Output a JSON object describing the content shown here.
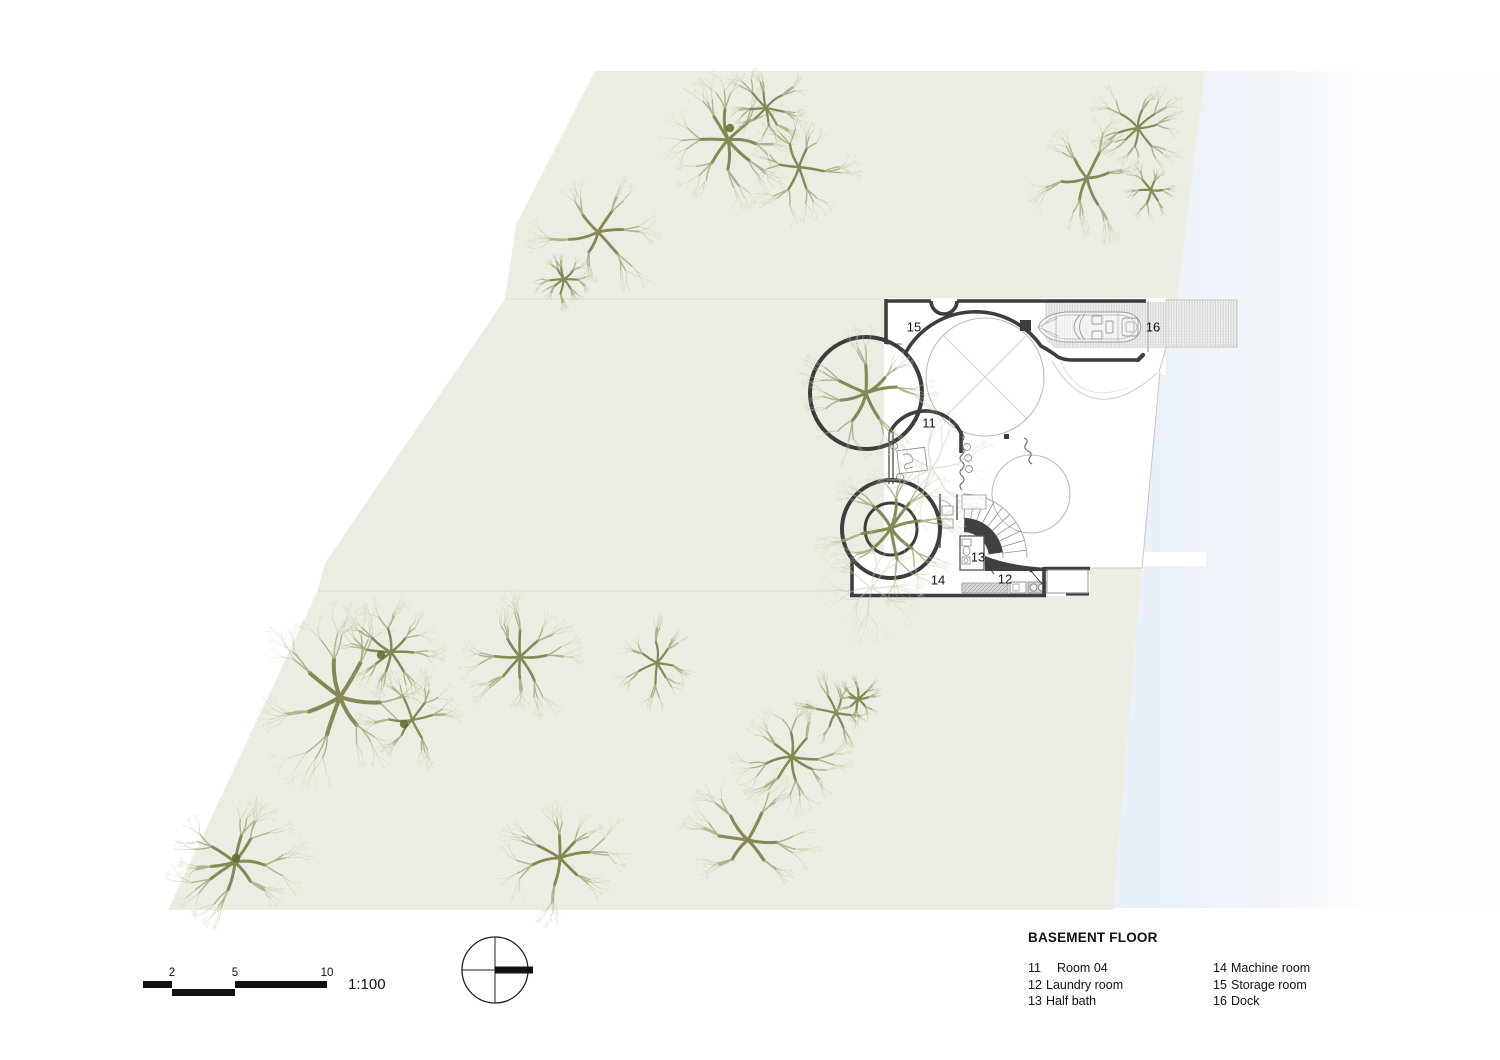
{
  "legend": {
    "title": "BASEMENT FLOOR",
    "columns": [
      [
        {
          "num": "11",
          "label": "Room 04",
          "indent": true
        },
        {
          "num": "12",
          "label": "Laundry room"
        },
        {
          "num": "13",
          "label": "Half bath"
        }
      ],
      [
        {
          "num": "14",
          "label": "Machine room"
        },
        {
          "num": "15",
          "label": "Storage room"
        },
        {
          "num": "16",
          "label": "Dock"
        }
      ]
    ]
  },
  "scale": {
    "ratio": "1:100",
    "ticks": [
      {
        "label": "2",
        "x": 172
      },
      {
        "label": "5",
        "x": 235
      },
      {
        "label": "10",
        "x": 327
      }
    ]
  },
  "plan_labels": [
    {
      "num": "15",
      "x": 914,
      "y": 327
    },
    {
      "num": "16",
      "x": 1153,
      "y": 327
    },
    {
      "num": "11",
      "x": 929,
      "y": 423
    },
    {
      "num": "13",
      "x": 978,
      "y": 557
    },
    {
      "num": "14",
      "x": 938,
      "y": 580
    },
    {
      "num": "12",
      "x": 1005,
      "y": 579
    }
  ],
  "colors": {
    "site_fill": "#ecede2",
    "parcel_line": "#dedfd3",
    "water_edge": "#e9f0f7",
    "wall": "#3d3d3d",
    "thin_line": "#bcbcbc",
    "tree_trunk": "#7f844e",
    "tree_twig": "#b8bb93",
    "text": "#161616"
  },
  "site": {
    "trees": [
      {
        "x": 728,
        "y": 140,
        "r": 55,
        "seed": 11
      },
      {
        "x": 766,
        "y": 108,
        "r": 36,
        "seed": 12
      },
      {
        "x": 799,
        "y": 167,
        "r": 44,
        "seed": 13
      },
      {
        "x": 598,
        "y": 232,
        "r": 52,
        "seed": 14
      },
      {
        "x": 564,
        "y": 279,
        "r": 27,
        "seed": 15
      },
      {
        "x": 1087,
        "y": 178,
        "r": 50,
        "seed": 16
      },
      {
        "x": 1138,
        "y": 128,
        "r": 40,
        "seed": 17
      },
      {
        "x": 1151,
        "y": 190,
        "r": 24,
        "seed": 18
      },
      {
        "x": 340,
        "y": 697,
        "r": 73,
        "seed": 19
      },
      {
        "x": 391,
        "y": 652,
        "r": 45,
        "seed": 20
      },
      {
        "x": 412,
        "y": 720,
        "r": 42,
        "seed": 21
      },
      {
        "x": 520,
        "y": 657,
        "r": 48,
        "seed": 22
      },
      {
        "x": 657,
        "y": 663,
        "r": 37,
        "seed": 23
      },
      {
        "x": 235,
        "y": 862,
        "r": 55,
        "seed": 24
      },
      {
        "x": 560,
        "y": 858,
        "r": 52,
        "seed": 25
      },
      {
        "x": 748,
        "y": 840,
        "r": 57,
        "seed": 26
      },
      {
        "x": 792,
        "y": 757,
        "r": 46,
        "seed": 27
      },
      {
        "x": 836,
        "y": 713,
        "r": 34,
        "seed": 28
      },
      {
        "x": 858,
        "y": 699,
        "r": 20,
        "seed": 29
      },
      {
        "x": 866,
        "y": 393,
        "r": 57,
        "seed": 30
      },
      {
        "x": 891,
        "y": 528,
        "r": 56,
        "seed": 31
      },
      {
        "x": 932,
        "y": 468,
        "r": 52,
        "seed": 32,
        "faint": true
      },
      {
        "x": 872,
        "y": 588,
        "r": 42,
        "seed": 33,
        "faint": true
      }
    ],
    "trunk_dots": [
      {
        "x": 730,
        "y": 128
      },
      {
        "x": 381,
        "y": 655
      },
      {
        "x": 404,
        "y": 724
      },
      {
        "x": 236,
        "y": 858
      }
    ]
  }
}
